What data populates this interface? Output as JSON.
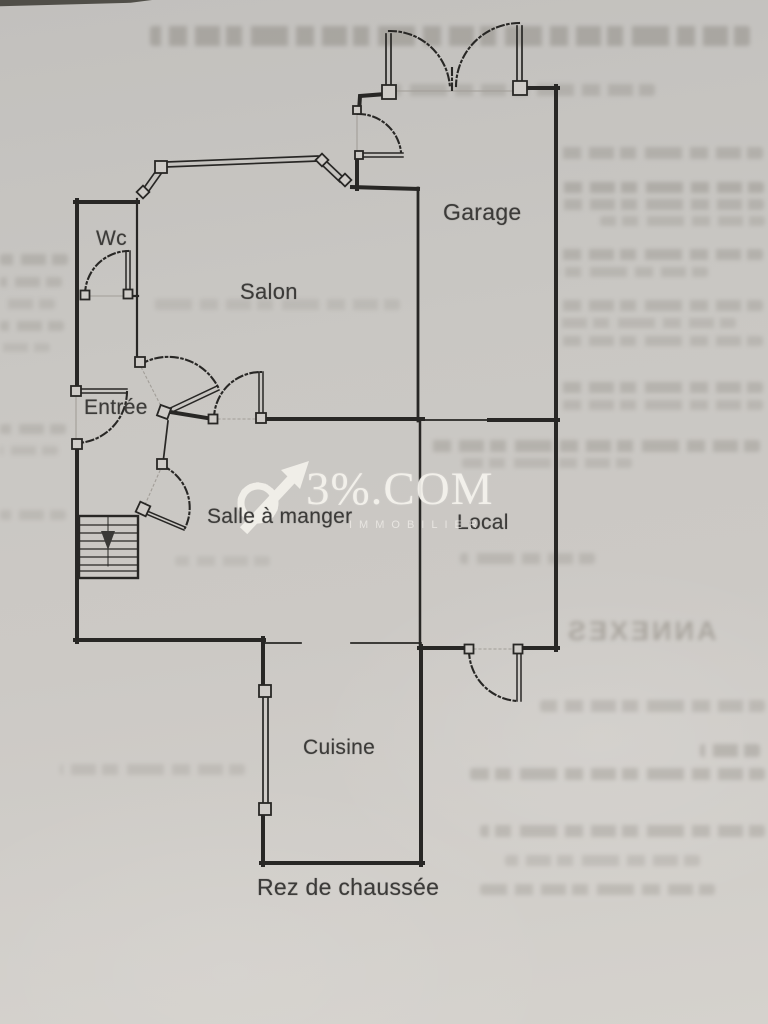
{
  "plan": {
    "title": "Rez de chaussée",
    "rooms": [
      {
        "id": "wc",
        "label": "Wc"
      },
      {
        "id": "salon",
        "label": "Salon"
      },
      {
        "id": "garage",
        "label": "Garage"
      },
      {
        "id": "entree",
        "label": "Entrée"
      },
      {
        "id": "salle-a-manger",
        "label": "Salle à manger"
      },
      {
        "id": "local",
        "label": "Local"
      },
      {
        "id": "cuisine",
        "label": "Cuisine"
      }
    ]
  },
  "watermark": {
    "brand": "3%.COM",
    "tagline": "IMMOBILIER"
  },
  "bleed_through": {
    "visible_word": "ANNEXES"
  },
  "colors": {
    "paper": "#c9c7c3",
    "ink": "#282725",
    "label_ink": "#3c3b39",
    "watermark": "#f4f2ed"
  }
}
